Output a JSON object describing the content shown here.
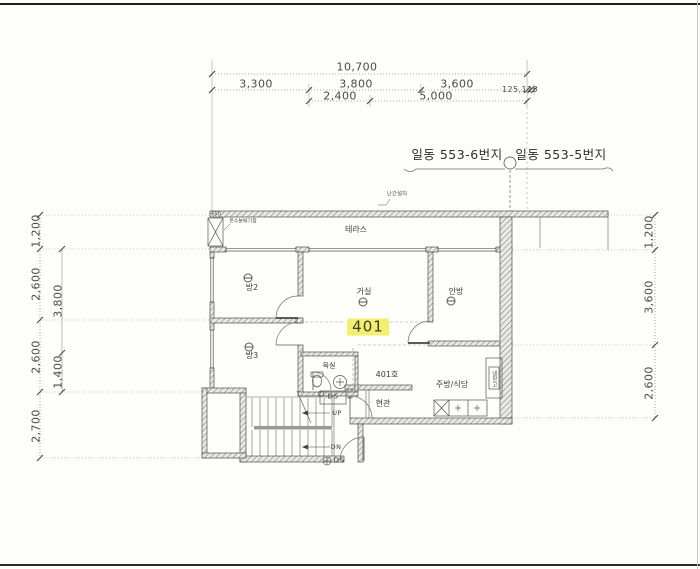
{
  "colors": {
    "highlight": "#f3ee6e",
    "ink": "#4a4a4a"
  },
  "dimensions": {
    "top": {
      "total": "10,700",
      "segments": [
        "3,300",
        "3,800",
        "3,600"
      ],
      "edge": "125,125",
      "sub": [
        "2,400",
        "5,000"
      ]
    },
    "left": {
      "outer": [
        "1,200",
        "2,600",
        "2,600",
        "2,700"
      ],
      "inner": [
        "3,800",
        "1,400"
      ]
    },
    "right": [
      "1,200",
      "3,600",
      "2,600"
    ]
  },
  "lots": {
    "left": "일동 553-6번지",
    "right": "일동 553-5번지"
  },
  "rooms": {
    "terrace": "테라스",
    "room2": "방2",
    "room3": "방3",
    "living": "거실",
    "master": "안방",
    "bath": "욕실",
    "kitchen": "주방/식당",
    "entrance": "현관",
    "fridge": "냉장고"
  },
  "unit": {
    "number": "401",
    "door": "401호"
  },
  "stairs": {
    "up": "UP",
    "down": "DN",
    "duct_top": "DS",
    "duct_bottom": "DS"
  },
  "notes": {
    "railing": "난간설치",
    "hot_water_box": "온수분배기함",
    "small_dim": "650"
  }
}
